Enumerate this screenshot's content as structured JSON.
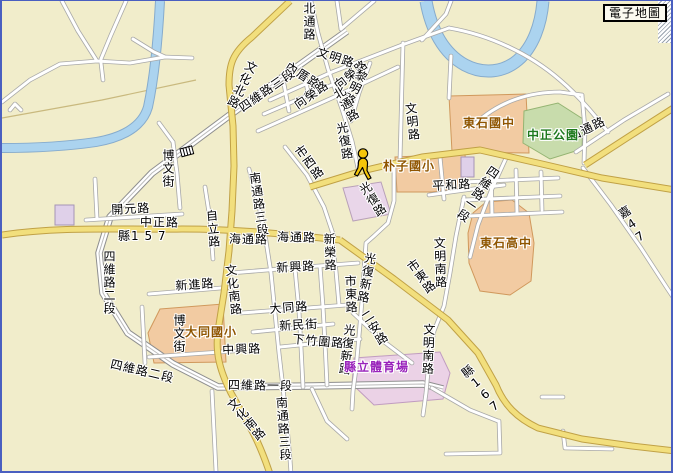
{
  "app": {
    "map_button_label": "電子地圖"
  },
  "colors": {
    "background": "#F1EDCB",
    "major_road": "#F2DF7D",
    "major_road_border": "#C0A146",
    "minor_road": "#FFFFFF",
    "minor_road_border": "#A8A8A8",
    "river": "#ABD3EF",
    "river_border": "#86ABCC",
    "park_fill": "#C8DCAC",
    "school_fill": "#F2CBA2",
    "stadium_fill": "#EBD2E6",
    "building_fill": "#DFD0E9",
    "school_text": "#8F5500",
    "park_text": "#1F7A1F",
    "stadium_text": "#9922BB",
    "frame": "#4A5FC0"
  },
  "icons": {
    "person_marker": "walking-person",
    "railway_icon": "railway-crossing"
  },
  "labels": {
    "roads": [
      {
        "t": "北通路",
        "x": 300,
        "y": 1,
        "d": "v",
        "r": 0
      },
      {
        "t": "文明路",
        "x": 317,
        "y": 45,
        "d": "h",
        "r": 18
      },
      {
        "t": "內厝路",
        "x": 288,
        "y": 59,
        "d": "h",
        "r": 33
      },
      {
        "t": "向榮路",
        "x": 330,
        "y": 81,
        "d": "h",
        "r": -38
      },
      {
        "t": "向榮路",
        "x": 290,
        "y": 100,
        "d": "h",
        "r": -35
      },
      {
        "t": "黎明路",
        "x": 355,
        "y": 66,
        "d": "v",
        "r": 26
      },
      {
        "t": "北通路",
        "x": 328,
        "y": 90,
        "d": "v",
        "r": -30
      },
      {
        "t": "文化北路",
        "x": 245,
        "y": 57,
        "d": "v",
        "r": 26
      },
      {
        "t": "四維路三段",
        "x": 235,
        "y": 103,
        "d": "h",
        "r": -35
      },
      {
        "t": "光復路",
        "x": 332,
        "y": 122,
        "d": "v",
        "r": -10
      },
      {
        "t": "文明路",
        "x": 401,
        "y": 102,
        "d": "v",
        "r": -6
      },
      {
        "t": "市西路",
        "x": 290,
        "y": 150,
        "d": "v",
        "r": -36
      },
      {
        "t": "南通路三段",
        "x": 245,
        "y": 172,
        "d": "v",
        "r": -8
      },
      {
        "t": "博文街",
        "x": 159,
        "y": 148,
        "d": "v",
        "r": 0
      },
      {
        "t": "開元路",
        "x": 109,
        "y": 203,
        "d": "h",
        "r": -3
      },
      {
        "t": "中正路",
        "x": 138,
        "y": 215,
        "d": "h",
        "r": 1
      },
      {
        "t": "自立路",
        "x": 202,
        "y": 209,
        "d": "v",
        "r": -5
      },
      {
        "t": "海通路",
        "x": 227,
        "y": 232,
        "d": "h",
        "r": 1
      },
      {
        "t": "海通路",
        "x": 275,
        "y": 230,
        "d": "h",
        "r": 1
      },
      {
        "t": "光復路",
        "x": 354,
        "y": 186,
        "d": "v",
        "r": -33
      },
      {
        "t": "平和路",
        "x": 430,
        "y": 179,
        "d": "h",
        "r": -3
      },
      {
        "t": "四維路一段",
        "x": 488,
        "y": 162,
        "d": "v",
        "r": 34
      },
      {
        "t": "新榮路",
        "x": 320,
        "y": 232,
        "d": "v",
        "r": -2
      },
      {
        "t": "新興路",
        "x": 274,
        "y": 261,
        "d": "h",
        "r": -3
      },
      {
        "t": "文化南路",
        "x": 221,
        "y": 264,
        "d": "v",
        "r": -7
      },
      {
        "t": "新進路",
        "x": 173,
        "y": 279,
        "d": "h",
        "r": -4
      },
      {
        "t": "文明南路",
        "x": 430,
        "y": 236,
        "d": "v",
        "r": -2
      },
      {
        "t": "市東路",
        "x": 341,
        "y": 274,
        "d": "v",
        "r": -2
      },
      {
        "t": "光復新路",
        "x": 362,
        "y": 250,
        "d": "v",
        "r": 10
      },
      {
        "t": "市東路",
        "x": 402,
        "y": 264,
        "d": "v",
        "r": -36
      },
      {
        "t": "大同路",
        "x": 267,
        "y": 302,
        "d": "h",
        "r": -4
      },
      {
        "t": "新民街",
        "x": 277,
        "y": 319,
        "d": "h",
        "r": -3
      },
      {
        "t": "下竹圍路",
        "x": 291,
        "y": 332,
        "d": "h",
        "r": 5
      },
      {
        "t": "中興路",
        "x": 220,
        "y": 343,
        "d": "h",
        "r": -2
      },
      {
        "t": "博文街",
        "x": 170,
        "y": 313,
        "d": "v",
        "r": 0
      },
      {
        "t": "四維路二段",
        "x": 100,
        "y": 249,
        "d": "v",
        "r": 0
      },
      {
        "t": "二安路",
        "x": 356,
        "y": 314,
        "d": "v",
        "r": -32
      },
      {
        "t": "光復新路",
        "x": 341,
        "y": 322,
        "d": "v",
        "r": 7
      },
      {
        "t": "文明南路",
        "x": 420,
        "y": 322,
        "d": "v",
        "r": 2
      },
      {
        "t": "四維路二段",
        "x": 110,
        "y": 357,
        "d": "h",
        "r": 13
      },
      {
        "t": "四維路一段",
        "x": 226,
        "y": 378,
        "d": "h",
        "r": 1
      },
      {
        "t": "南通路三段",
        "x": 272,
        "y": 396,
        "d": "v",
        "r": -4
      },
      {
        "t": "文化南路",
        "x": 222,
        "y": 403,
        "d": "v",
        "r": -40
      },
      {
        "t": "山通路",
        "x": 565,
        "y": 131,
        "d": "h",
        "r": -26
      }
    ],
    "route_numbers": [
      {
        "t": "縣1 5 7",
        "x": 116,
        "y": 229,
        "d": "h",
        "r": 0
      },
      {
        "t": "縣167",
        "x": 456,
        "y": 370,
        "d": "v",
        "r": -38
      },
      {
        "t": "嘉47",
        "x": 613,
        "y": 210,
        "d": "v",
        "r": -33
      }
    ],
    "places": [
      {
        "t": "朴子國小",
        "x": 381,
        "y": 159,
        "c": "#8F5500"
      },
      {
        "t": "東石國中",
        "x": 461,
        "y": 116,
        "c": "#8F5500"
      },
      {
        "t": "中正公園",
        "x": 525,
        "y": 128,
        "c": "#1F7A1F"
      },
      {
        "t": "東石高中",
        "x": 478,
        "y": 236,
        "c": "#8F5500"
      },
      {
        "t": "大同國小",
        "x": 183,
        "y": 325,
        "c": "#8F5500"
      },
      {
        "t": "縣立體育場",
        "x": 342,
        "y": 360,
        "c": "#9922BB"
      }
    ]
  }
}
